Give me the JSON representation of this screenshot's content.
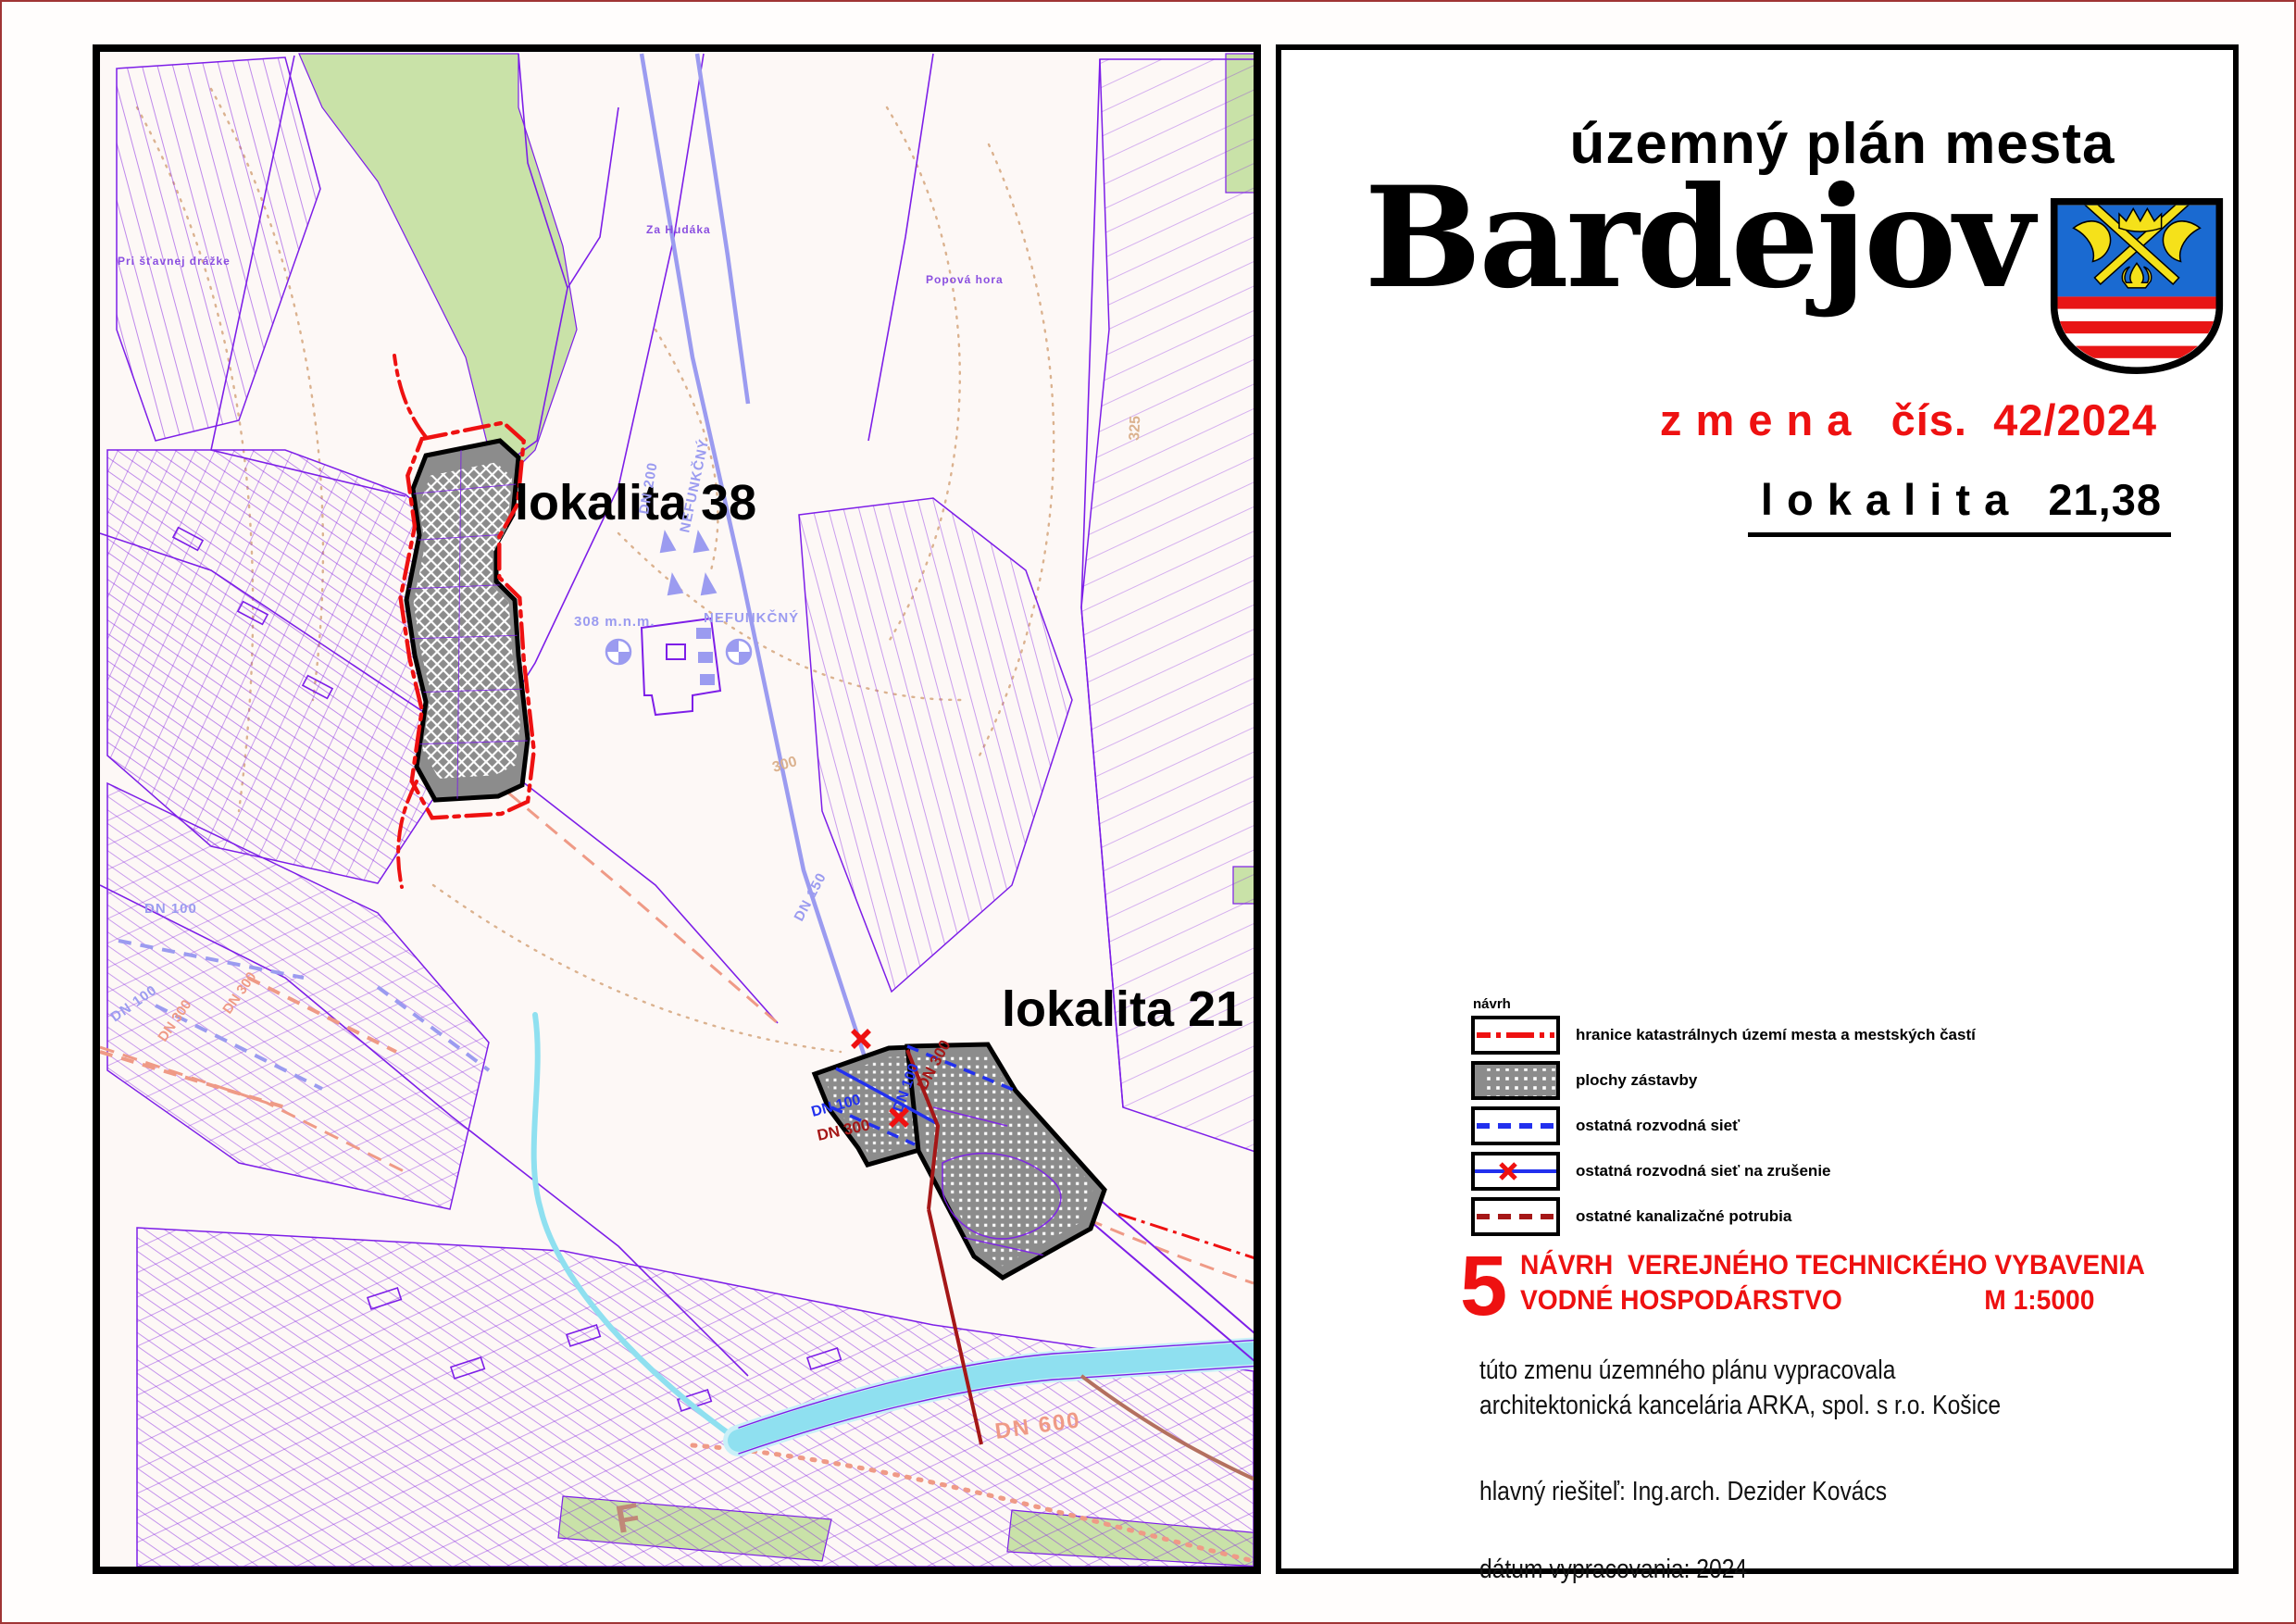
{
  "page": {
    "frame_color": "#a03535",
    "panel_border_color": "#000000"
  },
  "map_panel": {
    "labels": {
      "lokalita38": "lokalita 38",
      "lokalita21": "lokalita 21",
      "pri_stavnej_drazke": "Pri šťavnej drážke",
      "za_hudaka": "Za Hudáka",
      "popova_hora": "Popová hora",
      "elev_308": "308 m.n.m.",
      "nefunkcny_area": "NEFUNKČNÝ",
      "nefunkcny_pipe": "NEFUNKČNÝ",
      "dn200": "DN 200",
      "dn150": "DN 150",
      "dn100": "DN 100",
      "dn300": "DN 300",
      "dn600": "DN 600",
      "contour_300": "300",
      "contour_325": "325",
      "f_mark": "F"
    },
    "colors": {
      "parcel_purple": "#7d1ee8",
      "pipe_lavender": "#9b9bf0",
      "river_cyan": "#8fe0f0",
      "green_area": "#c9e2a8",
      "contour_tan": "#dbb28f",
      "boundary_red": "#ee1111",
      "sewer_dark_red": "#a51717",
      "salmon": "#ef9a86",
      "locality_gray": "#8c8c8c"
    }
  },
  "title_panel": {
    "plan_title": "územný plán mesta",
    "city": "Bardejov",
    "change_no": "z m e n a   čís.  42/2024",
    "locality": "l o k a l i t a   21,38",
    "legend": {
      "header": "návrh",
      "items": [
        {
          "id": "boundary",
          "label": "hranice katastrálnych území mesta a mestských častí"
        },
        {
          "id": "built-up",
          "label": "plochy zástavby"
        },
        {
          "id": "network",
          "label": "ostatná rozvodná sieť"
        },
        {
          "id": "network-cancel",
          "label": "ostatná rozvodná sieť na zrušenie"
        },
        {
          "id": "sewer",
          "label": "ostatné kanalizačné potrubia"
        }
      ]
    },
    "sheet": {
      "number": "5",
      "line1": "NÁVRH  VEREJNÉHO TECHNICKÉHO VYBAVENIA",
      "line2": "VODNÉ HOSPODÁRSTVO",
      "scale": "M 1:5000"
    },
    "credits": {
      "line1": "túto zmenu územného plánu vypracovala",
      "line2": "architektonická kancelária ARKA, spol. s r.o. Košice",
      "line3": "hlavný riešiteľ: Ing.arch. Dezider Kovács",
      "line4": "dátum vypracovania: 2024"
    }
  }
}
